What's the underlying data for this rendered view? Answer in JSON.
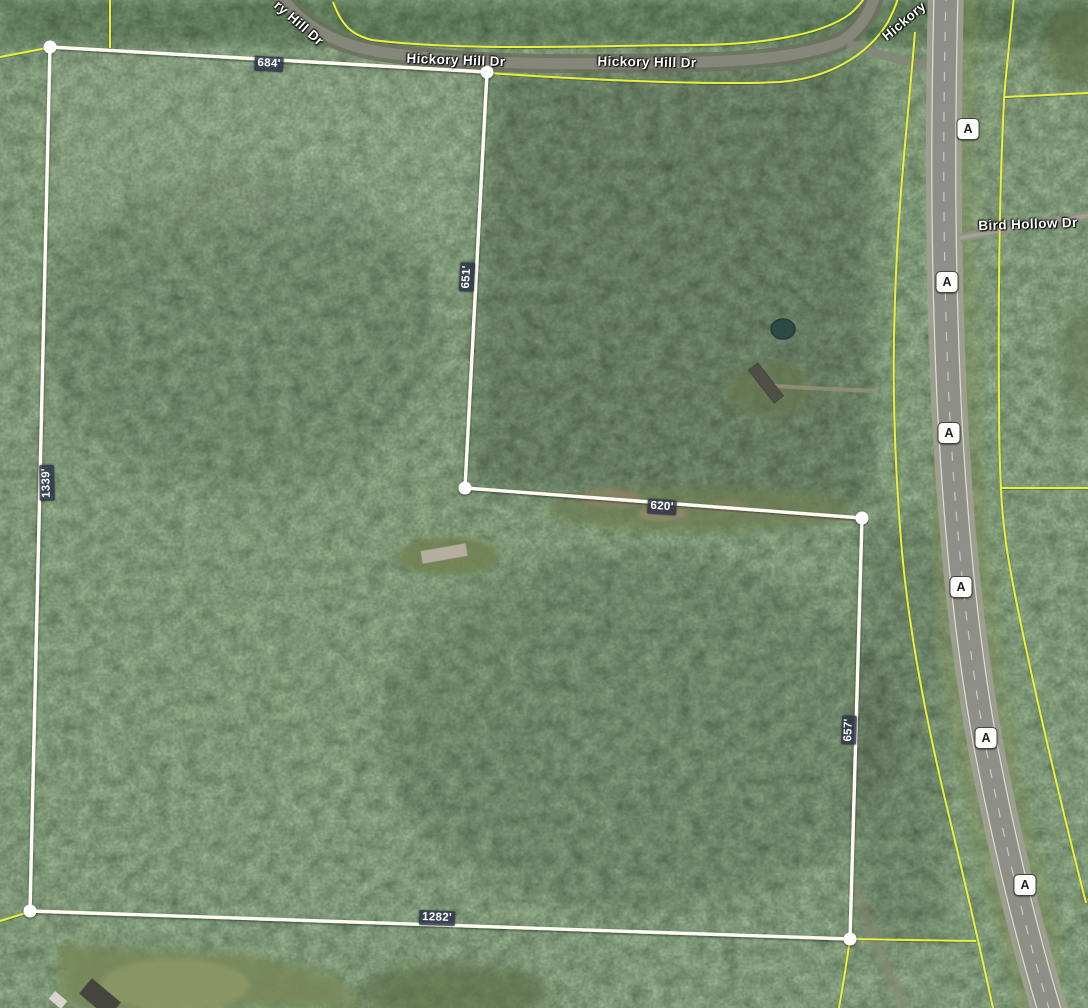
{
  "map": {
    "type": "satellite-parcel-view",
    "parcel": {
      "measurements": [
        {
          "id": "top-edge",
          "text": "684'"
        },
        {
          "id": "upper-right-edge",
          "text": "651'"
        },
        {
          "id": "middle-edge",
          "text": "620'"
        },
        {
          "id": "right-edge",
          "text": "657'"
        },
        {
          "id": "bottom-edge",
          "text": "1282'"
        },
        {
          "id": "left-edge",
          "text": "1339'"
        }
      ]
    },
    "roads": {
      "labels": [
        {
          "id": "hickory-hill-dr-rotated-left",
          "text": "ry Hill Dr"
        },
        {
          "id": "hickory-hill-dr-1",
          "text": "Hickory Hill Dr"
        },
        {
          "id": "hickory-hill-dr-2",
          "text": "Hickory Hill Dr"
        },
        {
          "id": "hickory-hill-dr-rotated-right",
          "text": "Hickory"
        },
        {
          "id": "bird-hollow-dr",
          "text": "Bird Hollow Dr"
        }
      ],
      "route_shields": [
        {
          "text": "A"
        },
        {
          "text": "A"
        },
        {
          "text": "A"
        },
        {
          "text": "A"
        },
        {
          "text": "A"
        },
        {
          "text": "A"
        }
      ]
    },
    "colors": {
      "boundary_white": "#fdfbf2",
      "parcel_line_yellow": "#e9ef3e",
      "measurement_badge_bg": "#293045",
      "forest_green": "#46563c",
      "field_green": "#7d8b5c",
      "highway_gray": "#8e9087",
      "shield_bg": "#fcfcf9"
    }
  }
}
